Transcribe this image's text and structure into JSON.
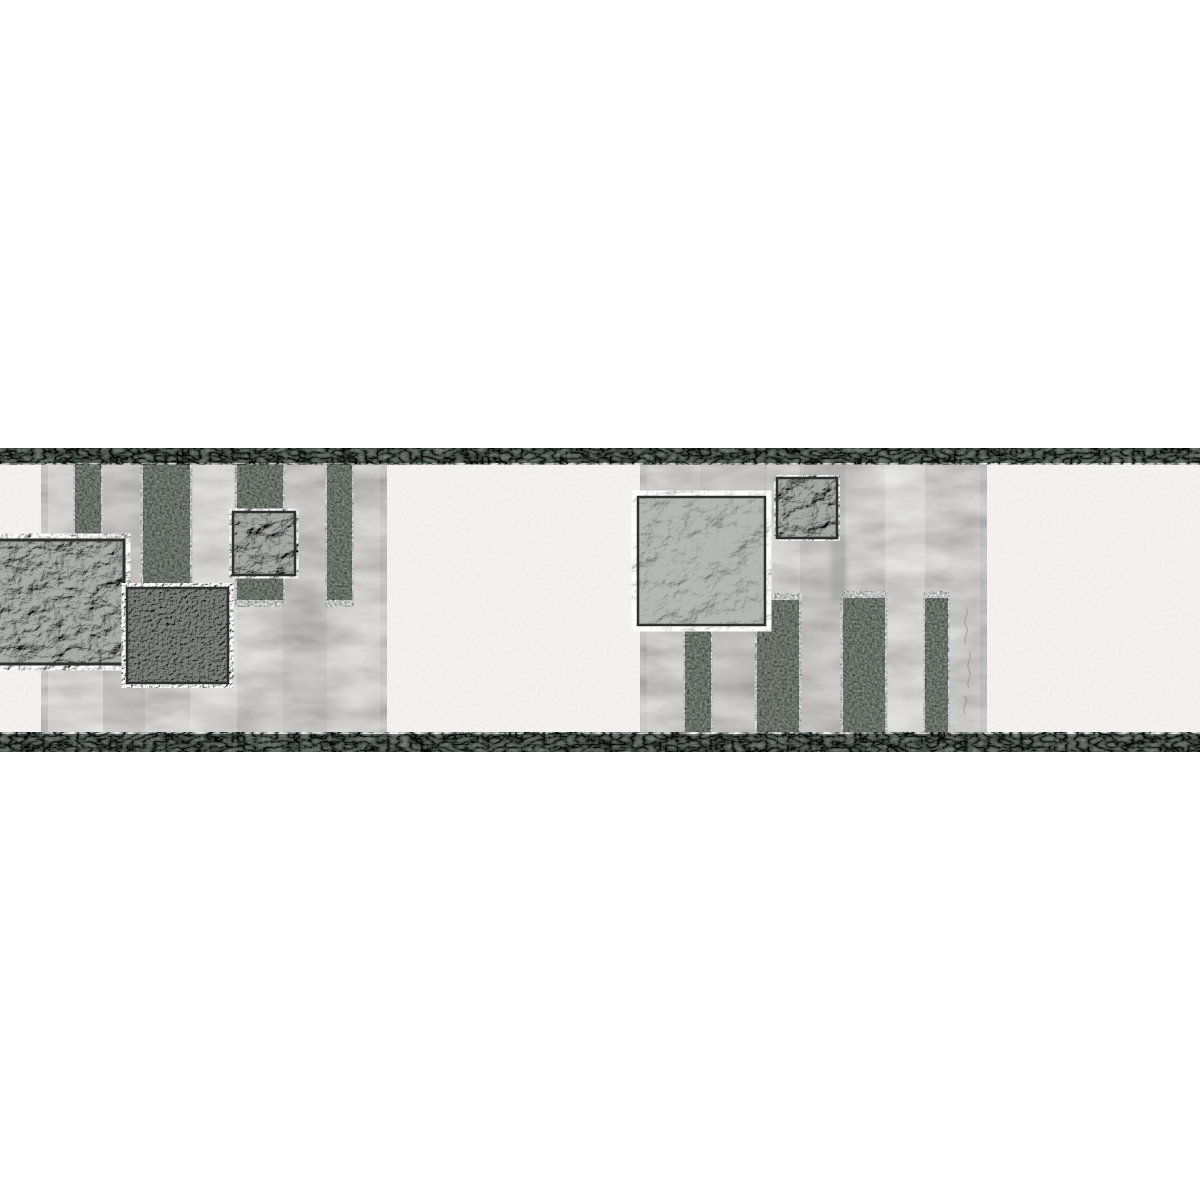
{
  "image": {
    "type": "product-photo",
    "subject": "Grey self-adhesive wallpaper border strip with concrete-look panels, crumpled-foil squares and granular vertical bars between dark granite edge bands",
    "orientation": "horizontal-strip"
  },
  "colors": {
    "page_background": "#ffffff",
    "edge_band": "#585d59",
    "field_white": "#f2f1ef",
    "panel_concrete": "#c6c5c3",
    "bar_dark": "#676d67",
    "square_foil_large": "#a9aea9",
    "square_foil_small": "#a5aaa5",
    "square_plaster": "#b3b8b3",
    "square_pebble": "#7e837e",
    "square_border": "#2c312d",
    "smudge": "#7d827d",
    "scribble": "#7f847f",
    "tint_dark": "#8e8d8b",
    "tint_light": "#ffffff"
  },
  "components": {
    "edge_band_top": "granite textured band, full width",
    "edge_band_bottom": "granite textured band, full width",
    "panel_left": "concrete panel behind left square cluster",
    "panel_right": "concrete panel behind right square cluster",
    "bars": "8 granular dark vertical bars hanging from top band or rising to bottom band",
    "squares": "5 textured relief squares (crumpled foil, pebbled, crumpled plaster)"
  }
}
